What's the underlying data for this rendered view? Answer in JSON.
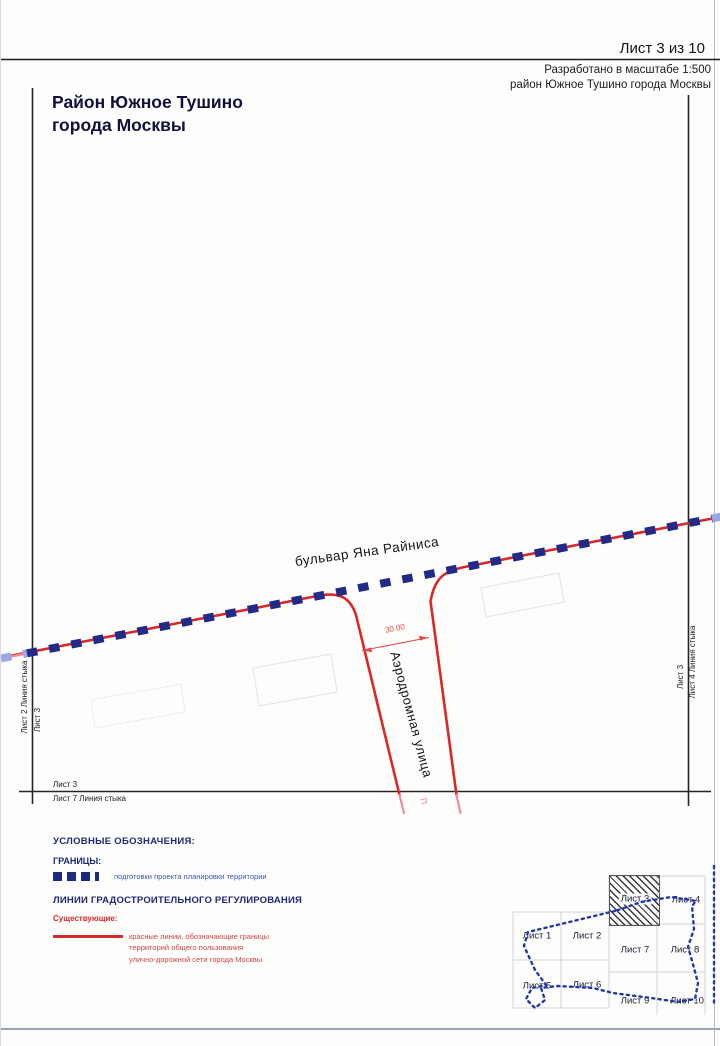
{
  "header": {
    "sheet_counter": "Лист 3 из 10",
    "note_line1": "Разработано в масштабе 1:500",
    "note_line2": "район Южное Тушино города Москвы"
  },
  "title": {
    "line1": "Район Южное Тушино",
    "line2": "города Москвы"
  },
  "map": {
    "boulevard_label": "бульвар Яна Райниса",
    "street_label": "Аэродромная улица",
    "dimension_value": "30.00",
    "cut_mark": "П",
    "edges": {
      "left_outer": "Лист 2 Линия стыка",
      "left_inner": "Лист 3",
      "right_inner": "Лист 3",
      "right_outer": "Лист 4 Линия стыка",
      "bottom_above": "Лист 3",
      "bottom_below": "Лист 7 Линия стыка"
    }
  },
  "legend": {
    "title": "УСЛОВНЫЕ ОБОЗНАЧЕНИЯ:",
    "borders_heading": "ГРАНИЦЫ:",
    "borders_item": "подготовки проекта планировки территории",
    "lines_heading": "ЛИНИИ ГРАДОСТРОИТЕЛЬНОГО РЕГУЛИРОВАНИЯ",
    "existing_label": "Существующие:",
    "red_line_desc1": "красные линии, обозначающие границы",
    "red_line_desc2": "территорий общего пользования",
    "red_line_desc3": "улично-дорожной сети города Москвы"
  },
  "index_map": {
    "current_sheet": "Лист 3",
    "sheets": [
      "Лист 1",
      "Лист 2",
      "Лист 3",
      "Лист 4",
      "Лист 5",
      "Лист 6",
      "Лист 7",
      "Лист 8",
      "Лист 9",
      "Лист 10"
    ]
  },
  "colors": {
    "red_line": "#da2828",
    "boundary_dash_blue": "#222a88",
    "navy_heading": "#1e2878",
    "district_boundary_blue": "#2438aa"
  }
}
